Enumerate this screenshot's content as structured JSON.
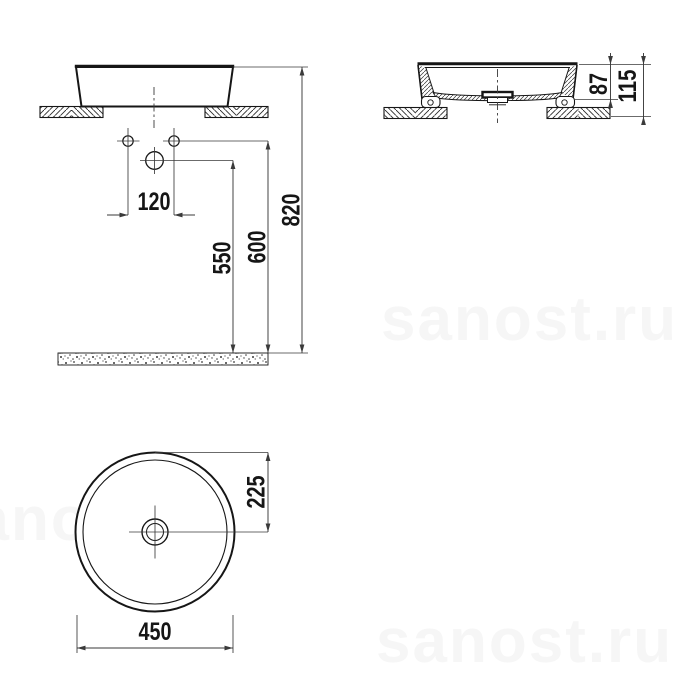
{
  "colors": {
    "line": "#161616",
    "dim": "#3a3a3a",
    "watermark": "#f6f6f6",
    "background": "#ffffff"
  },
  "watermarks": [
    {
      "text": "sanost.ru"
    },
    {
      "text": "sanost.ru"
    },
    {
      "text": "sanost.ru"
    }
  ],
  "views": {
    "front": {
      "dims": {
        "hole_spacing": "120",
        "drain_height": "550",
        "holes_height": "600",
        "rim_height": "820"
      }
    },
    "side": {
      "dims": {
        "bowl_depth": "87",
        "total_height": "115"
      }
    },
    "top": {
      "dims": {
        "center_offset": "225",
        "outer_diameter": "450"
      }
    }
  }
}
